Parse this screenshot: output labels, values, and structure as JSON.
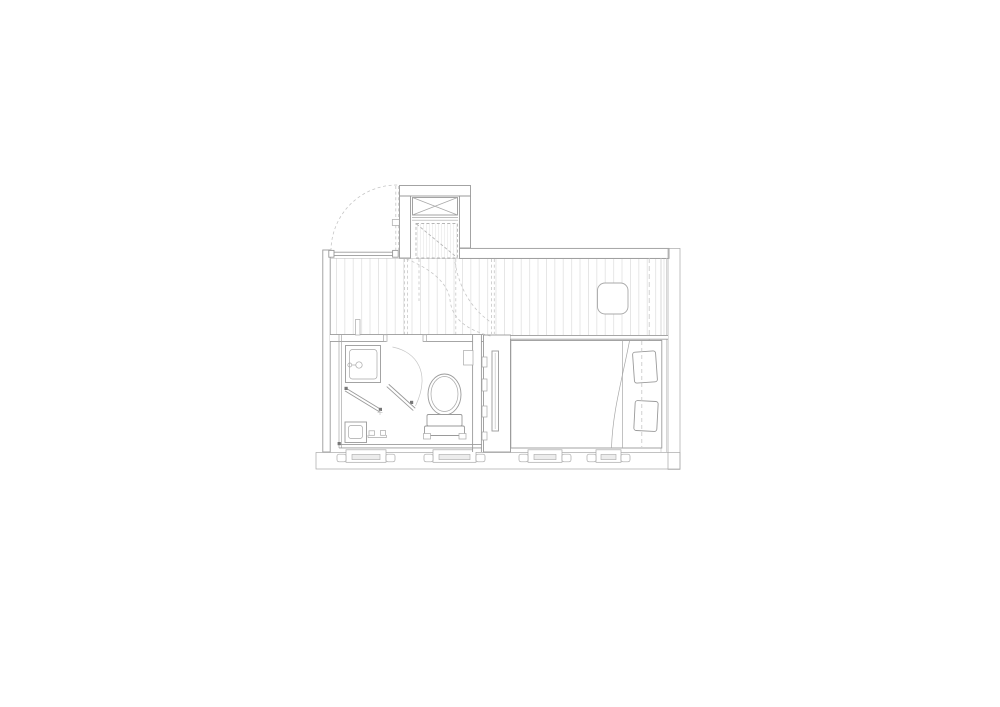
{
  "page": {
    "background_color": "#ffffff",
    "description": "architectural floor plan line drawing on white paper"
  },
  "drawing": {
    "type": "floor-plan",
    "colors": {
      "wall_line": "#9a9a9a",
      "fixture_line": "#a8a8a8",
      "faint_line": "#c6c6c6",
      "dashed_line": "#c6c6c6",
      "poche_fill": "#d6d6d6",
      "poche_stripe": "#e5e5e5",
      "board_line": "#e1e1e1",
      "marker": "#777777",
      "paper": "#ffffff"
    },
    "elements": {
      "lift_shaft": "hatched shaft with cross-braced void and dashed hatch opening",
      "deck": "timber-boarded floor strip",
      "rooflight": "rounded-corner rooflight",
      "bathroom": "shower room with shower tray, mixer valve, WC, wall niche and floor drain",
      "partition": "cross-hatched partition with tall panel",
      "bedroom": "double bed with two pillows and folded duvet",
      "window_units_count": 4,
      "door_swings_count": 2
    }
  }
}
